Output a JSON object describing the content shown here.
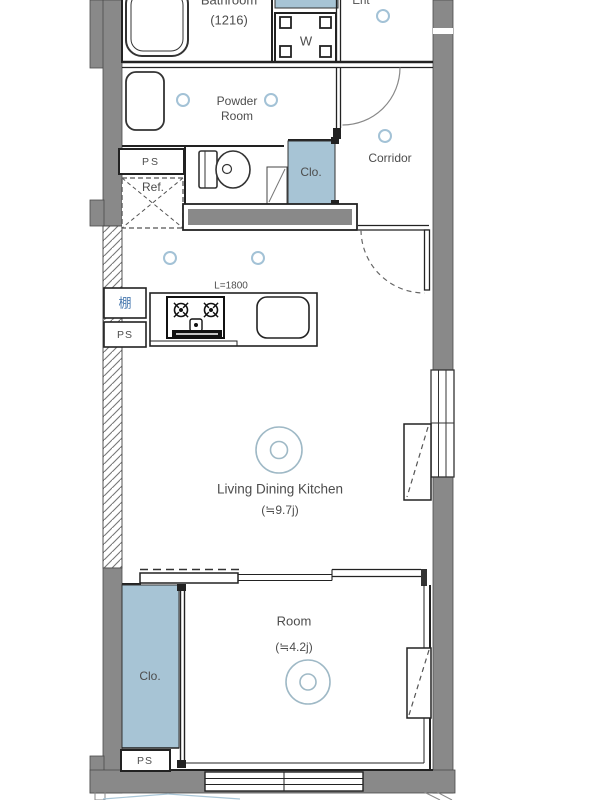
{
  "floorplan": {
    "bathroom": {
      "label": "Bathroom",
      "size": "(1216)"
    },
    "washer": {
      "label": "W"
    },
    "entrance": {
      "label": "Ent"
    },
    "powder_room": {
      "line1": "Powder",
      "line2": "Room"
    },
    "corridor": {
      "label": "Corridor"
    },
    "toilet_ps": {
      "label": "PS"
    },
    "refrigerator": {
      "label": "Ref."
    },
    "corridor_closet": {
      "label": "Clo."
    },
    "kitchen": {
      "counter_length": "L=1800",
      "shelf": "棚",
      "ps": "PS"
    },
    "ldk": {
      "label": "Living Dining Kitchen",
      "size": "(≒9.7j)"
    },
    "room": {
      "label": "Room",
      "size": "(≒4.2j)"
    },
    "room_closet": {
      "label": "Clo."
    },
    "room_ps": {
      "label": "PS"
    },
    "colors": {
      "wall_gray": "#898989",
      "fixture_blue": "#a7c4d5",
      "light_ring_blue": "#9fb9c6",
      "downlight_blue": "#a3c2d6",
      "line_dark": "#222222",
      "text_gray": "#4d4d4d",
      "shelf_text_blue": "#4a7ab0"
    }
  }
}
